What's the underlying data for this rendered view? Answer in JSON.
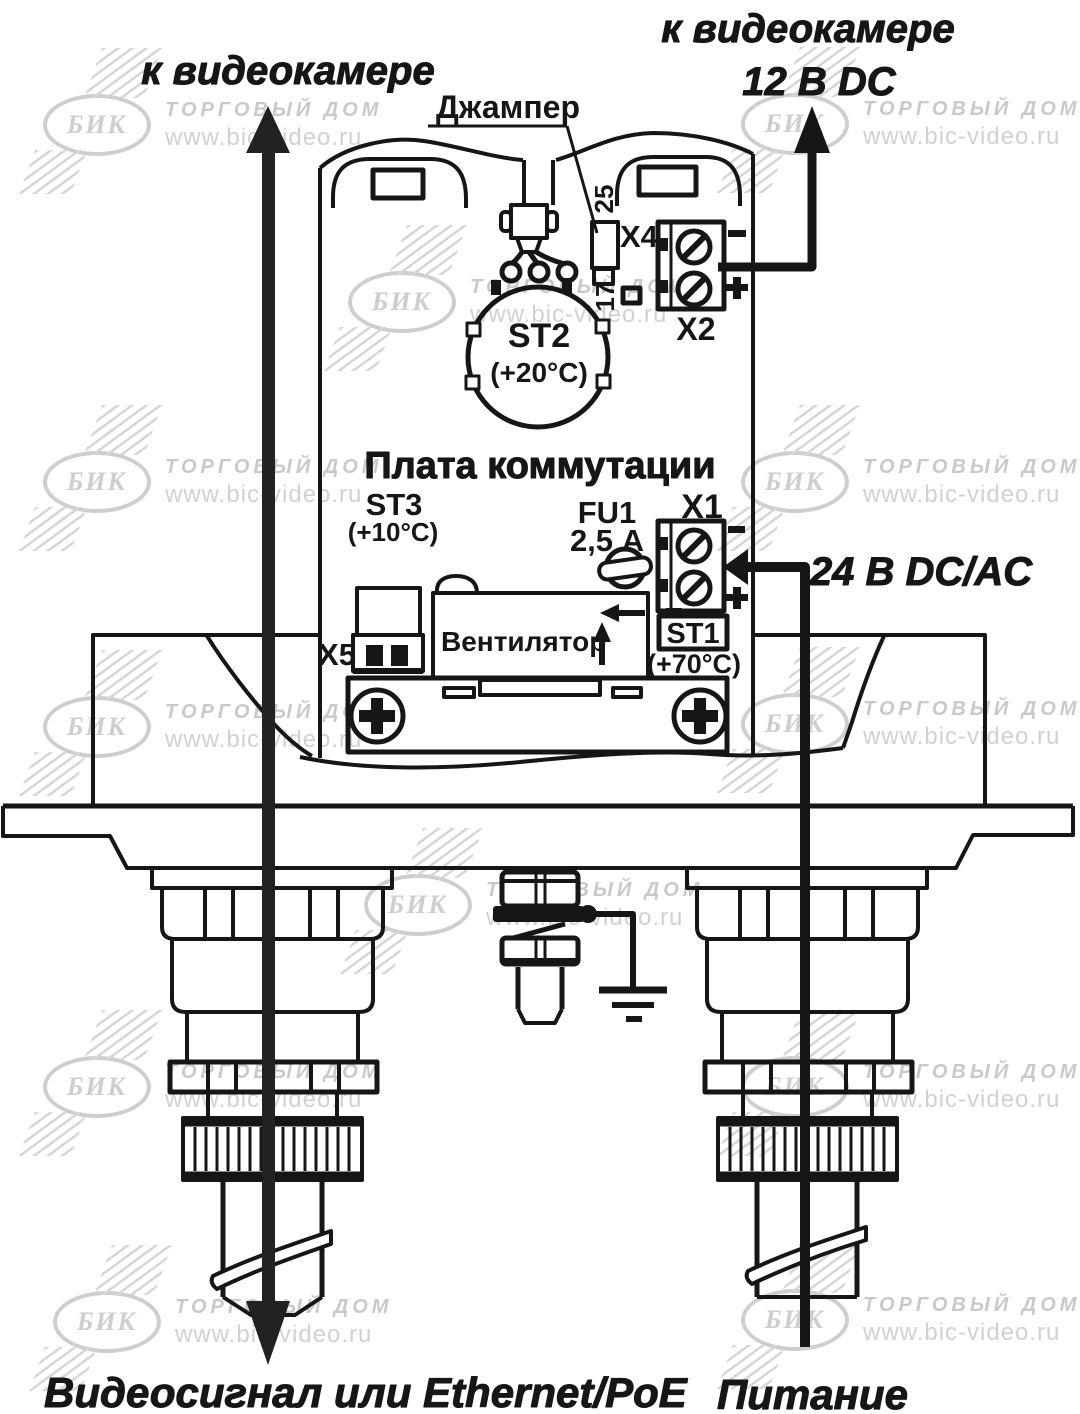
{
  "labels": {
    "to_camera_left": "к видеокамере",
    "to_camera_right": "к видеокамере",
    "voltage_12": "12 В DC",
    "voltage_24": "24 В DC/AC",
    "jumper": "Джампер",
    "board_title": "Плата коммутации",
    "x4": "X4",
    "x2": "X2",
    "x1": "X1",
    "x5": "X5",
    "st2": "ST2",
    "st2_temp": "(+20°C)",
    "st3": "ST3",
    "st3_temp": "(+10°C)",
    "st1": "ST1",
    "st1_temp": "(+70°C)",
    "fu1": "FU1",
    "fu1_rating": "2,5 А",
    "fan": "Вентилятор",
    "silk_25": "25",
    "silk_17": "17",
    "x2_minus": "-",
    "x2_plus": "+",
    "x1_minus": "-",
    "x1_plus": "+",
    "bottom_left": "Видеосигнал или Ethernet/PoE",
    "bottom_right": "Питание"
  },
  "watermark": {
    "brand": "БИК",
    "line1": "ТОРГОВЫЙ ДОМ",
    "line2": "www.bic-video.ru",
    "color": "#c9c9c9",
    "instances": [
      {
        "x": 43,
        "y": 94
      },
      {
        "x": 741,
        "y": 93
      },
      {
        "x": 348,
        "y": 271
      },
      {
        "x": 43,
        "y": 451
      },
      {
        "x": 741,
        "y": 451
      },
      {
        "x": 43,
        "y": 696
      },
      {
        "x": 741,
        "y": 693
      },
      {
        "x": 364,
        "y": 874
      },
      {
        "x": 43,
        "y": 1056
      },
      {
        "x": 741,
        "y": 1056
      },
      {
        "x": 53,
        "y": 1291
      },
      {
        "x": 741,
        "y": 1289
      }
    ]
  },
  "colors": {
    "line": "#161616",
    "watermark": "#c9c9c9",
    "background": "#ffffff"
  }
}
